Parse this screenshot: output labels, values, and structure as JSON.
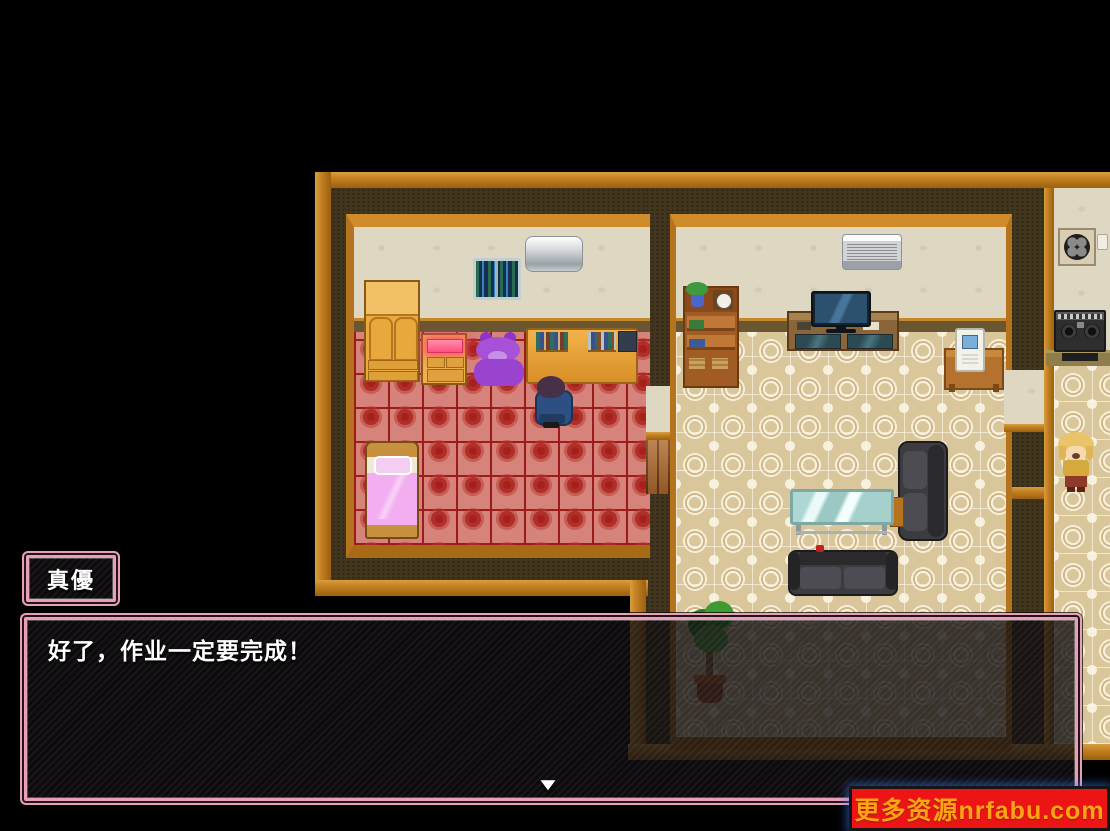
{
  "scene": {
    "name": "house-interior-map",
    "rooms": [
      "bedroom",
      "living-room",
      "kitchen"
    ],
    "sprites": [
      "wall-window",
      "air-conditioner",
      "wardrobe",
      "dresser",
      "glowing-item",
      "teddy-bear",
      "desk",
      "books",
      "student-on-chair",
      "bed",
      "bookshelf",
      "plant-pot",
      "wall-clock",
      "tv",
      "tv-stand",
      "side-table",
      "white-appliance",
      "sofa-vertical",
      "sofa-horizontal",
      "glass-table",
      "potted-plant",
      "ventilation-fan",
      "stove",
      "blonde-girl"
    ]
  },
  "dialogue": {
    "speaker_name": "真優",
    "text": "好了，作业一定要完成！",
    "continue_glyph": "▼"
  },
  "watermark": {
    "text": "更多资源nrfabu.com"
  },
  "colors": {
    "frame_orange": "#c07d1f",
    "wall_dark": "#43361f",
    "wall_cream": "#ded8c3",
    "carpet_red": "#b8302a",
    "tile_beige": "#d9c69b",
    "dialogue_border_pink": "#e9a0b6",
    "watermark_background": "#ec1414",
    "watermark_text": "#ffa414"
  }
}
